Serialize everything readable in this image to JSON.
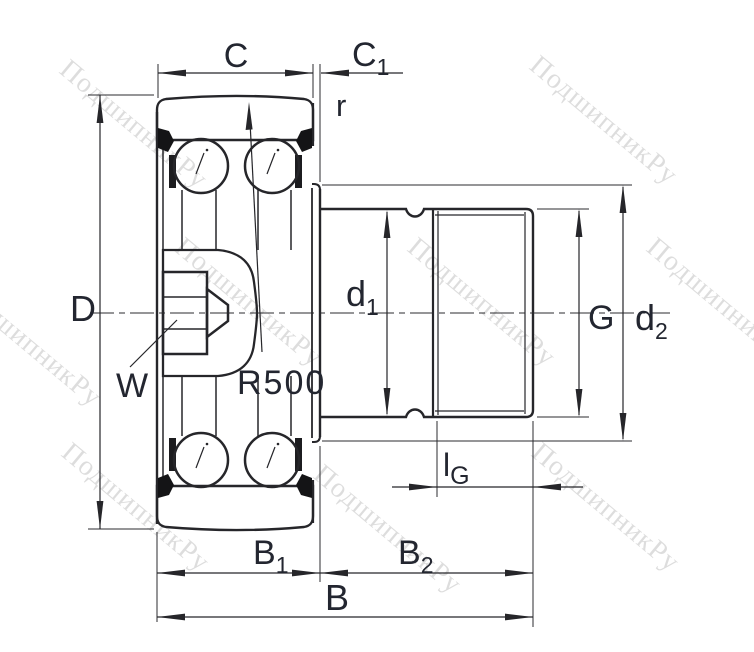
{
  "watermark": {
    "text": "ПодшипникРу"
  },
  "labels": {
    "c": "C",
    "c1_main": "C",
    "c1_sub": "1",
    "r": "r",
    "D": "D",
    "w": "W",
    "r500": "R500",
    "d1_main": "d",
    "d1_sub": "1",
    "g": "G",
    "d2_main": "d",
    "d2_sub": "2",
    "lg_main": "l",
    "lg_sub": "G",
    "b1_main": "B",
    "b1_sub": "1",
    "b2_main": "B",
    "b2_sub": "2",
    "b": "B"
  },
  "colors": {
    "line": "#26262a",
    "label": "#232630",
    "background": "#ffffff",
    "watermark_opacity": "0.13"
  }
}
